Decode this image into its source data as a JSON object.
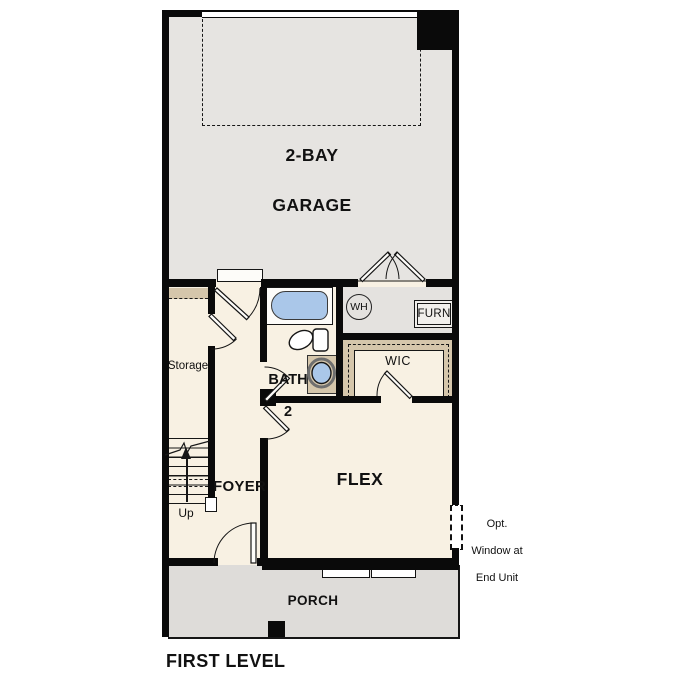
{
  "plan": {
    "title": "FIRST LEVEL",
    "rooms": {
      "garage": {
        "label_line1": "2-BAY",
        "label_line2": "GARAGE"
      },
      "storage": {
        "label": "Storage"
      },
      "bath": {
        "label_line1": "BATH",
        "label_line2": "2"
      },
      "wic": {
        "label": "WIC"
      },
      "foyer": {
        "label": "FOYER"
      },
      "flex": {
        "label": "FLEX"
      },
      "porch": {
        "label": "PORCH"
      }
    },
    "equipment": {
      "water_heater": {
        "label": "WH"
      },
      "furnace": {
        "label": "FURN"
      }
    },
    "stairs": {
      "direction_label": "Up"
    },
    "annotations": {
      "opt_window": {
        "line1": "Opt.",
        "line2": "Window at",
        "line3": "End Unit"
      }
    },
    "colors": {
      "wall": "#0a0a0a",
      "garage_floor": "#e6e4e1",
      "interior_floor": "#f8f1e3",
      "closet_tan": "#d5c6ab",
      "fixture_blue": "#aac7e9",
      "porch_floor": "#dedcd9"
    }
  }
}
